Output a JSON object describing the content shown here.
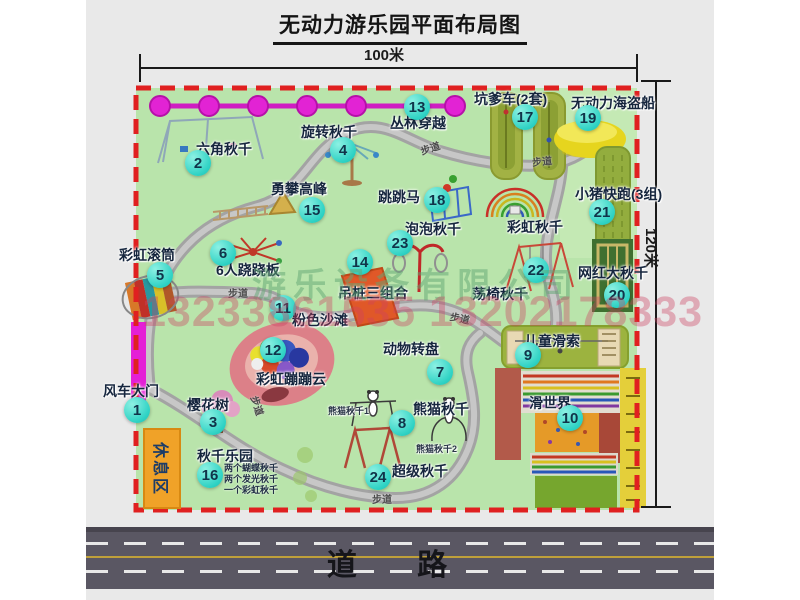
{
  "title": "无动力游乐园平面布局图",
  "dimensions": {
    "top": "100米",
    "right": "120米"
  },
  "road_label": "道 路",
  "rest_area_label": "休息区",
  "walkway_label": "步道",
  "watermark": {
    "company": "游乐设备有限公司",
    "phones": "13233861535 13202178333"
  },
  "attractions": [
    {
      "num": "1",
      "label": "风车大门"
    },
    {
      "num": "2",
      "label": "六角秋千"
    },
    {
      "num": "3",
      "label": "樱花树"
    },
    {
      "num": "4",
      "label": "旋转秋千"
    },
    {
      "num": "5",
      "label": "彩虹滚筒"
    },
    {
      "num": "6",
      "label": "6人跷跷板"
    },
    {
      "num": "7",
      "label": "动物转盘"
    },
    {
      "num": "8",
      "label": "熊猫秋千"
    },
    {
      "num": "9",
      "label": "儿童滑索"
    },
    {
      "num": "10",
      "label": "滑世界"
    },
    {
      "num": "11",
      "label": "粉色沙滩"
    },
    {
      "num": "12",
      "label": "彩虹蹦蹦云"
    },
    {
      "num": "13",
      "label": "丛林穿越"
    },
    {
      "num": "14",
      "label": "吊桩三组合"
    },
    {
      "num": "15",
      "label": "勇攀高峰"
    },
    {
      "num": "16",
      "label": "秋千乐园"
    },
    {
      "num": "17",
      "label": "坑爹车(2套)"
    },
    {
      "num": "18",
      "label": "跳跳马"
    },
    {
      "num": "19",
      "label": "无动力海盗船"
    },
    {
      "num": "20",
      "label": "网红大秋千"
    },
    {
      "num": "21",
      "label": "小猪快跑(3组)"
    },
    {
      "num": "22",
      "label": "荡椅秋千"
    },
    {
      "num": "23",
      "label": "泡泡秋千"
    },
    {
      "num": "24",
      "label": "超级秋千"
    }
  ],
  "extra_labels": {
    "rainbow_swing": "彩虹秋千",
    "panda_swing_1": "熊猫秋千1",
    "panda_swing_2": "熊猫秋千2"
  },
  "swing_park_notes": [
    "两个蝴蝶秋千",
    "两个发光秋千",
    "一个彩虹秋千"
  ]
}
